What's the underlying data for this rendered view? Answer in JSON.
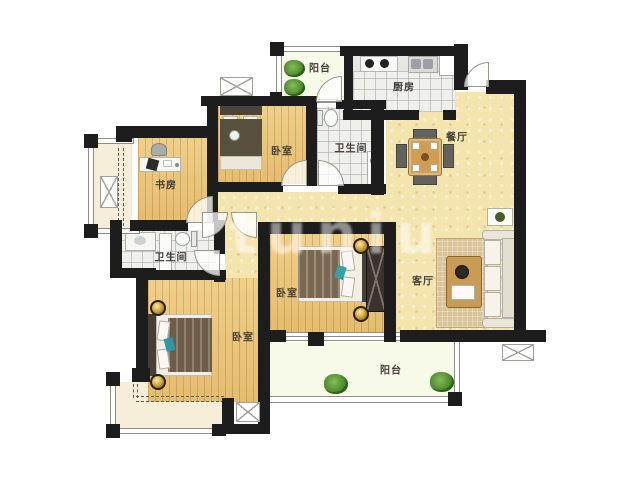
{
  "watermark": "tuniu",
  "colors": {
    "wall": "#1d1d1d",
    "wood_floor": "#e9c478",
    "tile_floor": "#efefec",
    "living_floor": "#f4e4ae",
    "balcony_floor": "#f7f9e9",
    "bay_floor": "#f6eed8",
    "lamp_gold": "#c79a2e",
    "plant_green": "#3f7c27",
    "accent_teal": "#36a0ab"
  },
  "rooms": [
    {
      "id": "balcony-top",
      "label": "阳台"
    },
    {
      "id": "kitchen",
      "label": "厨房"
    },
    {
      "id": "dining",
      "label": "餐厅"
    },
    {
      "id": "bedroom-top",
      "label": "卧室"
    },
    {
      "id": "bathroom-top",
      "label": "卫生间"
    },
    {
      "id": "study",
      "label": "书房"
    },
    {
      "id": "bathroom-middle",
      "label": "卫生间"
    },
    {
      "id": "bedroom-middle",
      "label": "卧室"
    },
    {
      "id": "living-room",
      "label": "客厅"
    },
    {
      "id": "bedroom-left",
      "label": "卧室"
    },
    {
      "id": "balcony-bottom",
      "label": "阳台"
    }
  ],
  "furniture_icons": [
    "bed-icon",
    "wardrobe-icon",
    "sofa-icon",
    "coffee-table-icon",
    "rug-icon",
    "dining-table-icon",
    "dining-chair-icon",
    "desk-icon",
    "desk-chair-icon",
    "stove-icon",
    "kitchen-sink-icon",
    "fridge-icon",
    "toilet-icon",
    "shower-icon",
    "washbasin-icon",
    "bedside-lamp-icon",
    "plant-icon",
    "ac-platform-icon",
    "door-swing-icon"
  ]
}
